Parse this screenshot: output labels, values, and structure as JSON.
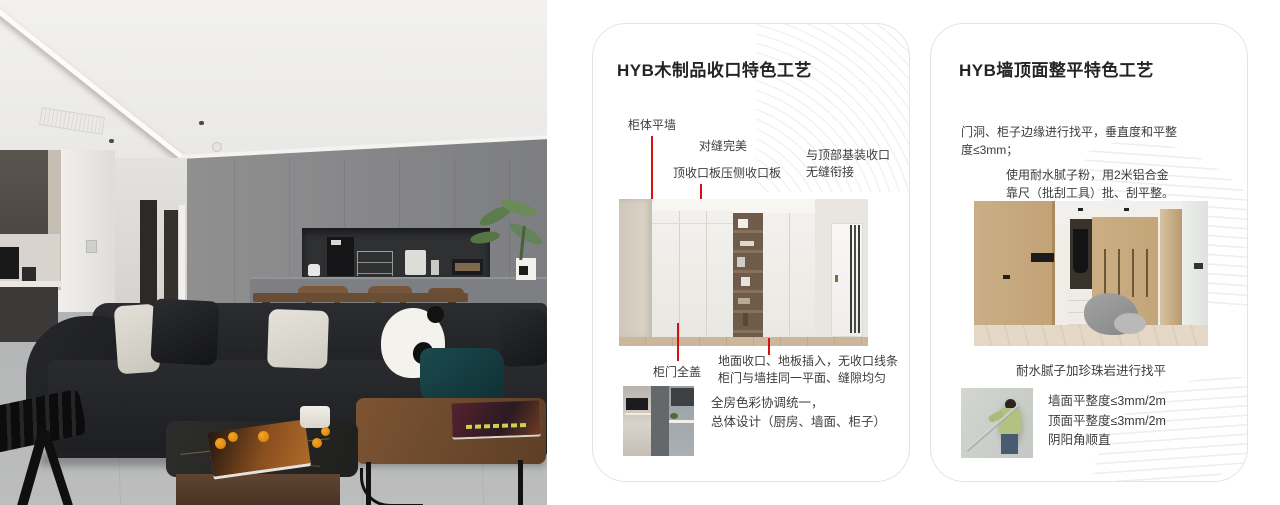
{
  "palette": {
    "accent_red": "#d31212",
    "card_border": "#e4e4e4",
    "title_text": "#242424",
    "body_text": "#3c3c3c",
    "wall_gray": "#87888b",
    "sofa_black": "#232427",
    "wood_brown": "#6f4b2d"
  },
  "photo": {
    "description_objects": [
      "ceiling-vent",
      "kitchen-cabinets",
      "appliance-niche",
      "plant",
      "dining-table",
      "black-sofa",
      "panda-cushion",
      "teal-blanket",
      "coffee-tables",
      "magazines",
      "oranges",
      "mug",
      "folding-stool"
    ]
  },
  "card1": {
    "title": "HYB木制品收口特色工艺",
    "callouts": {
      "cabinet_flush_wall": "柜体平墙",
      "perfect_seam": "对缝完美",
      "top_panel": "顶收口板压侧收口板",
      "top_joint": "与顶部基装收口\n无缝衔接",
      "full_cover_door": "柜门全盖",
      "floor_note": "地面收口、地板插入，无收口线条\n柜门与墙挂同一平面、缝隙均匀"
    },
    "summary": "全房色彩协调统一，\n总体设计（厨房、墙面、柜子）"
  },
  "card2": {
    "title": "HYB墙顶面整平特色工艺",
    "para1": "门洞、柜子边缘进行找平，垂直度和平整\n度≤3mm；",
    "para2": "使用耐水腻子粉，用2米铝合金\n靠尺（批刮工具）批、刮平整。",
    "caption": "耐水腻子加珍珠岩进行找平",
    "specs": [
      "墙面平整度≤3mm/2m",
      "顶面平整度≤3mm/2m",
      "阴阳角顺直"
    ]
  }
}
